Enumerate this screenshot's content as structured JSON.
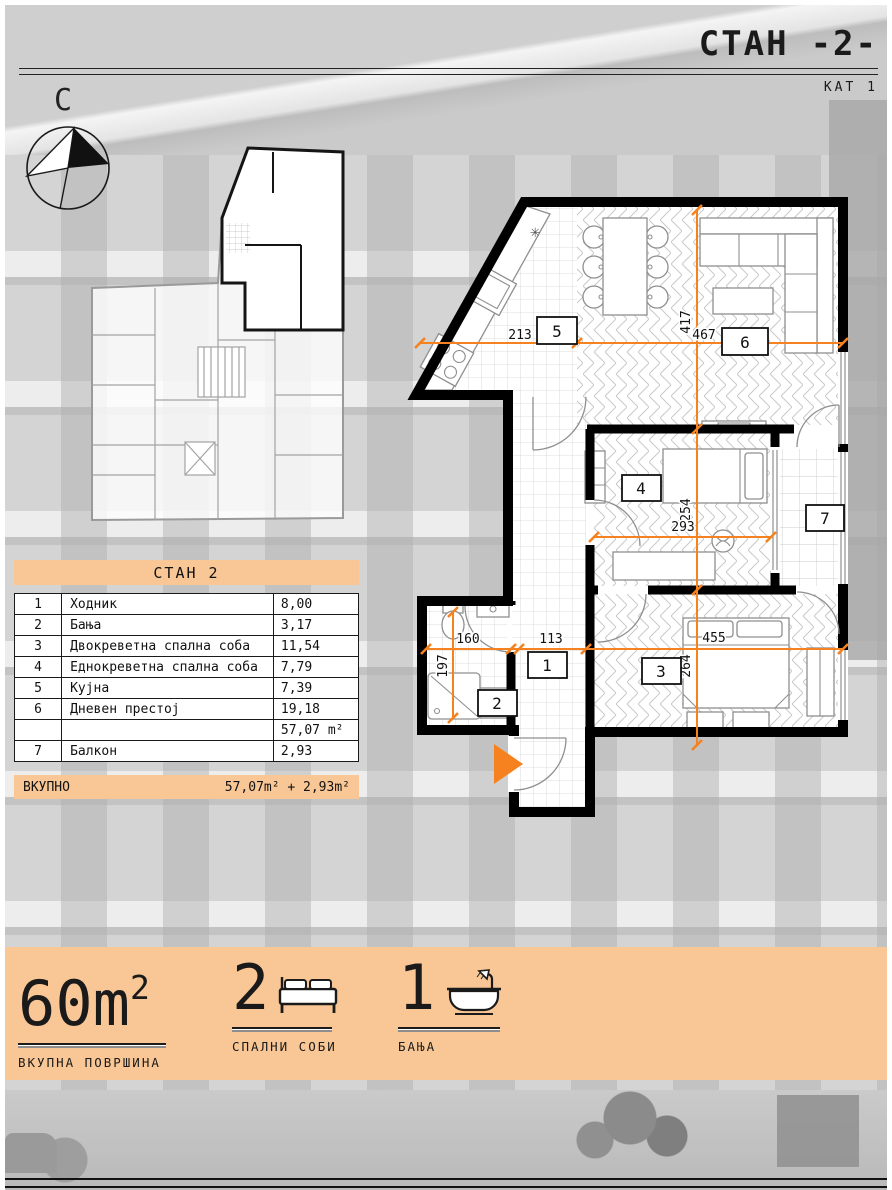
{
  "page": {
    "title_main": "СТАН",
    "title_num": "-2-",
    "floor": "КАТ 1"
  },
  "compass": {
    "north_letter": "С"
  },
  "table": {
    "header": "СТАН 2",
    "rows": [
      {
        "num": "1",
        "label": "Ходник",
        "value": "8,00"
      },
      {
        "num": "2",
        "label": "Бања",
        "value": "3,17"
      },
      {
        "num": "3",
        "label": "Двокреветна спална соба",
        "value": "11,54"
      },
      {
        "num": "4",
        "label": "Еднокреветна спална соба",
        "value": "7,79"
      },
      {
        "num": "5",
        "label": "Кујна",
        "value": "7,39"
      },
      {
        "num": "6",
        "label": "Дневен престој",
        "value": "19,18"
      },
      {
        "num": "",
        "label": "",
        "value": "57,07 m²"
      },
      {
        "num": "7",
        "label": "Балкон",
        "value": "2,93"
      }
    ],
    "total_label": "ВКУПНО",
    "total_value": "57,07m² + 2,93m²"
  },
  "plan": {
    "dims": {
      "kitchen_w": "213",
      "living_w": "467",
      "living_h": "417",
      "bed4_w": "293",
      "bed4_h": "254",
      "bath_w": "160",
      "bath_h": "197",
      "hall_w": "113",
      "bed3_w": "455",
      "bed3_h": "264"
    },
    "rooms": [
      "1",
      "2",
      "3",
      "4",
      "5",
      "6",
      "7"
    ]
  },
  "stats": [
    {
      "value": "60m",
      "sup": "2",
      "label": "ВКУПНА ПОВРШИНА"
    },
    {
      "value": "2",
      "sup": "",
      "label": "СПАЛНИ СОБИ"
    },
    {
      "value": "1",
      "sup": "",
      "label": "БАЊА"
    }
  ],
  "colors": {
    "accent": "#F5821F",
    "band": "#F9C795"
  }
}
